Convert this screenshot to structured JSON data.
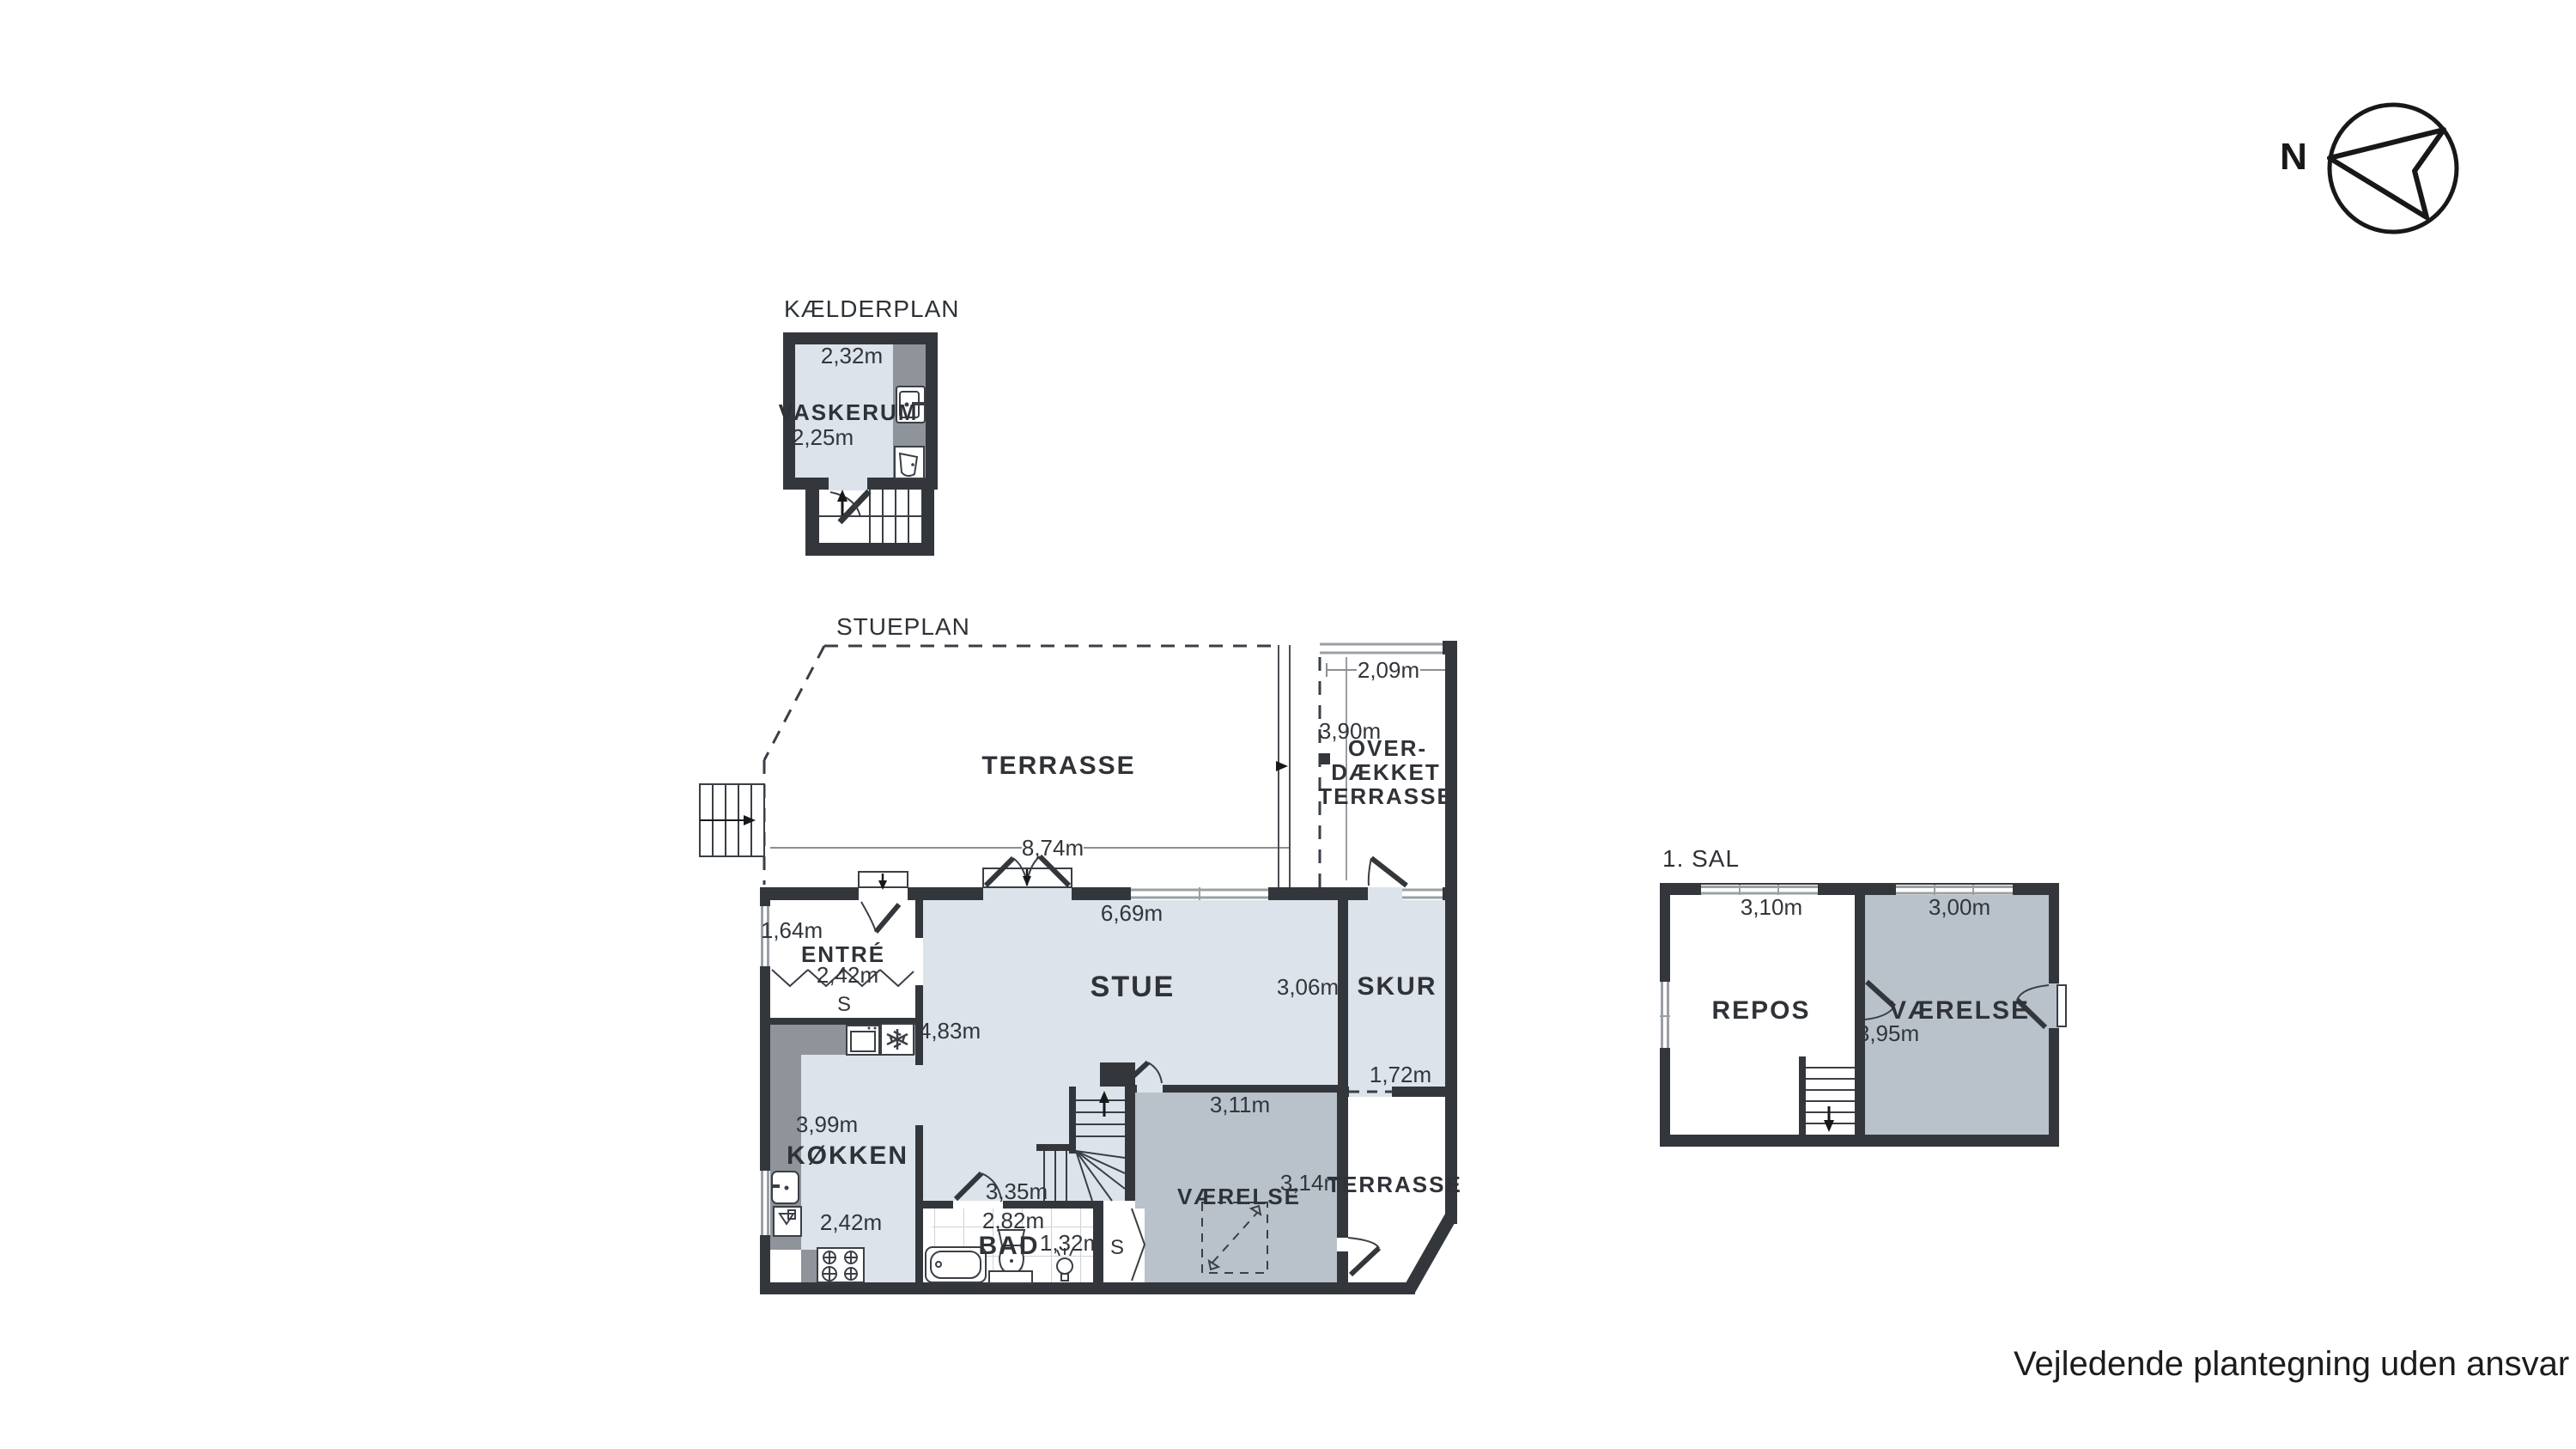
{
  "compass": {
    "north_label": "N"
  },
  "disclaimer": {
    "text": "Vejledende plantegning uden ansvar"
  },
  "colors": {
    "wall": "#33373c",
    "floor_light": "#dce3ea",
    "floor_dark": "#b9c1cb",
    "counter": "#8e9499",
    "text": "#2f3237"
  },
  "basement": {
    "title": "KÆLDERPLAN",
    "room_label": "VASKERUM",
    "width_dim": "2,32m",
    "depth_dim": "2,25m"
  },
  "ground_floor": {
    "title": "STUEPLAN",
    "terrace_label": "TERRASSE",
    "terrace_width_dim": "8,74m",
    "covered_terrace_line1": "OVER-",
    "covered_terrace_line2": "DÆKKET",
    "covered_terrace_line3": "TERRASSE",
    "covered_terrace_width_dim": "2,09m",
    "covered_terrace_depth_dim": "3,90m",
    "entre_label": "ENTRÉ",
    "entre_depth_dim": "1,64m",
    "entre_width_dim": "2,42m",
    "entre_closet_label": "S",
    "stue_label": "STUE",
    "stue_width_dim": "6,69m",
    "stue_depth_dim": "4,83m",
    "stue_right_dim": "3,06m",
    "koekken_label": "KØKKEN",
    "koekken_depth_dim": "3,99m",
    "koekken_width_dim": "2,42m",
    "stair_dim": "3,35m",
    "bad_label": "BAD",
    "bad_width_dim": "2,82m",
    "bad_right_dim": "1,32m",
    "bad_closet_label": "S",
    "vaerelse_label": "VÆRELSE",
    "vaerelse_width_dim": "3,11m",
    "vaerelse_depth_dim": "3,14m",
    "skur_label": "SKUR",
    "skur_width_dim": "1,72m",
    "terrace_south_label": "TERRASSE"
  },
  "first_floor": {
    "title": "1. SAL",
    "repos_label": "REPOS",
    "repos_width_dim": "3,10m",
    "vaerelse_label": "VÆRELSE",
    "vaerelse_width_dim": "3,00m",
    "vaerelse_depth_dim": "3,95m"
  }
}
